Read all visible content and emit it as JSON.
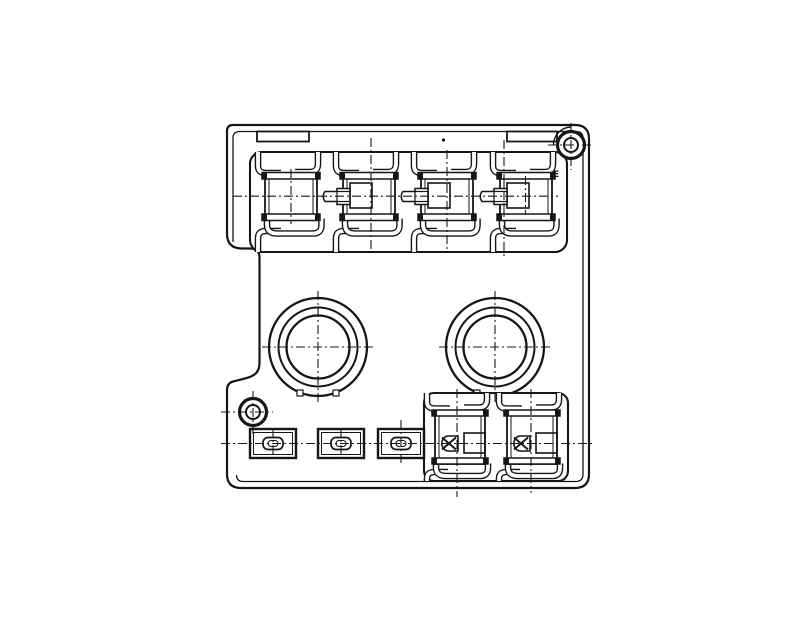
{
  "drawing": {
    "labels": {
      "corner_label": "E"
    },
    "colors": {
      "line": "#161616",
      "background": "#ffffff",
      "centerline": "#1a1a1a"
    }
  }
}
